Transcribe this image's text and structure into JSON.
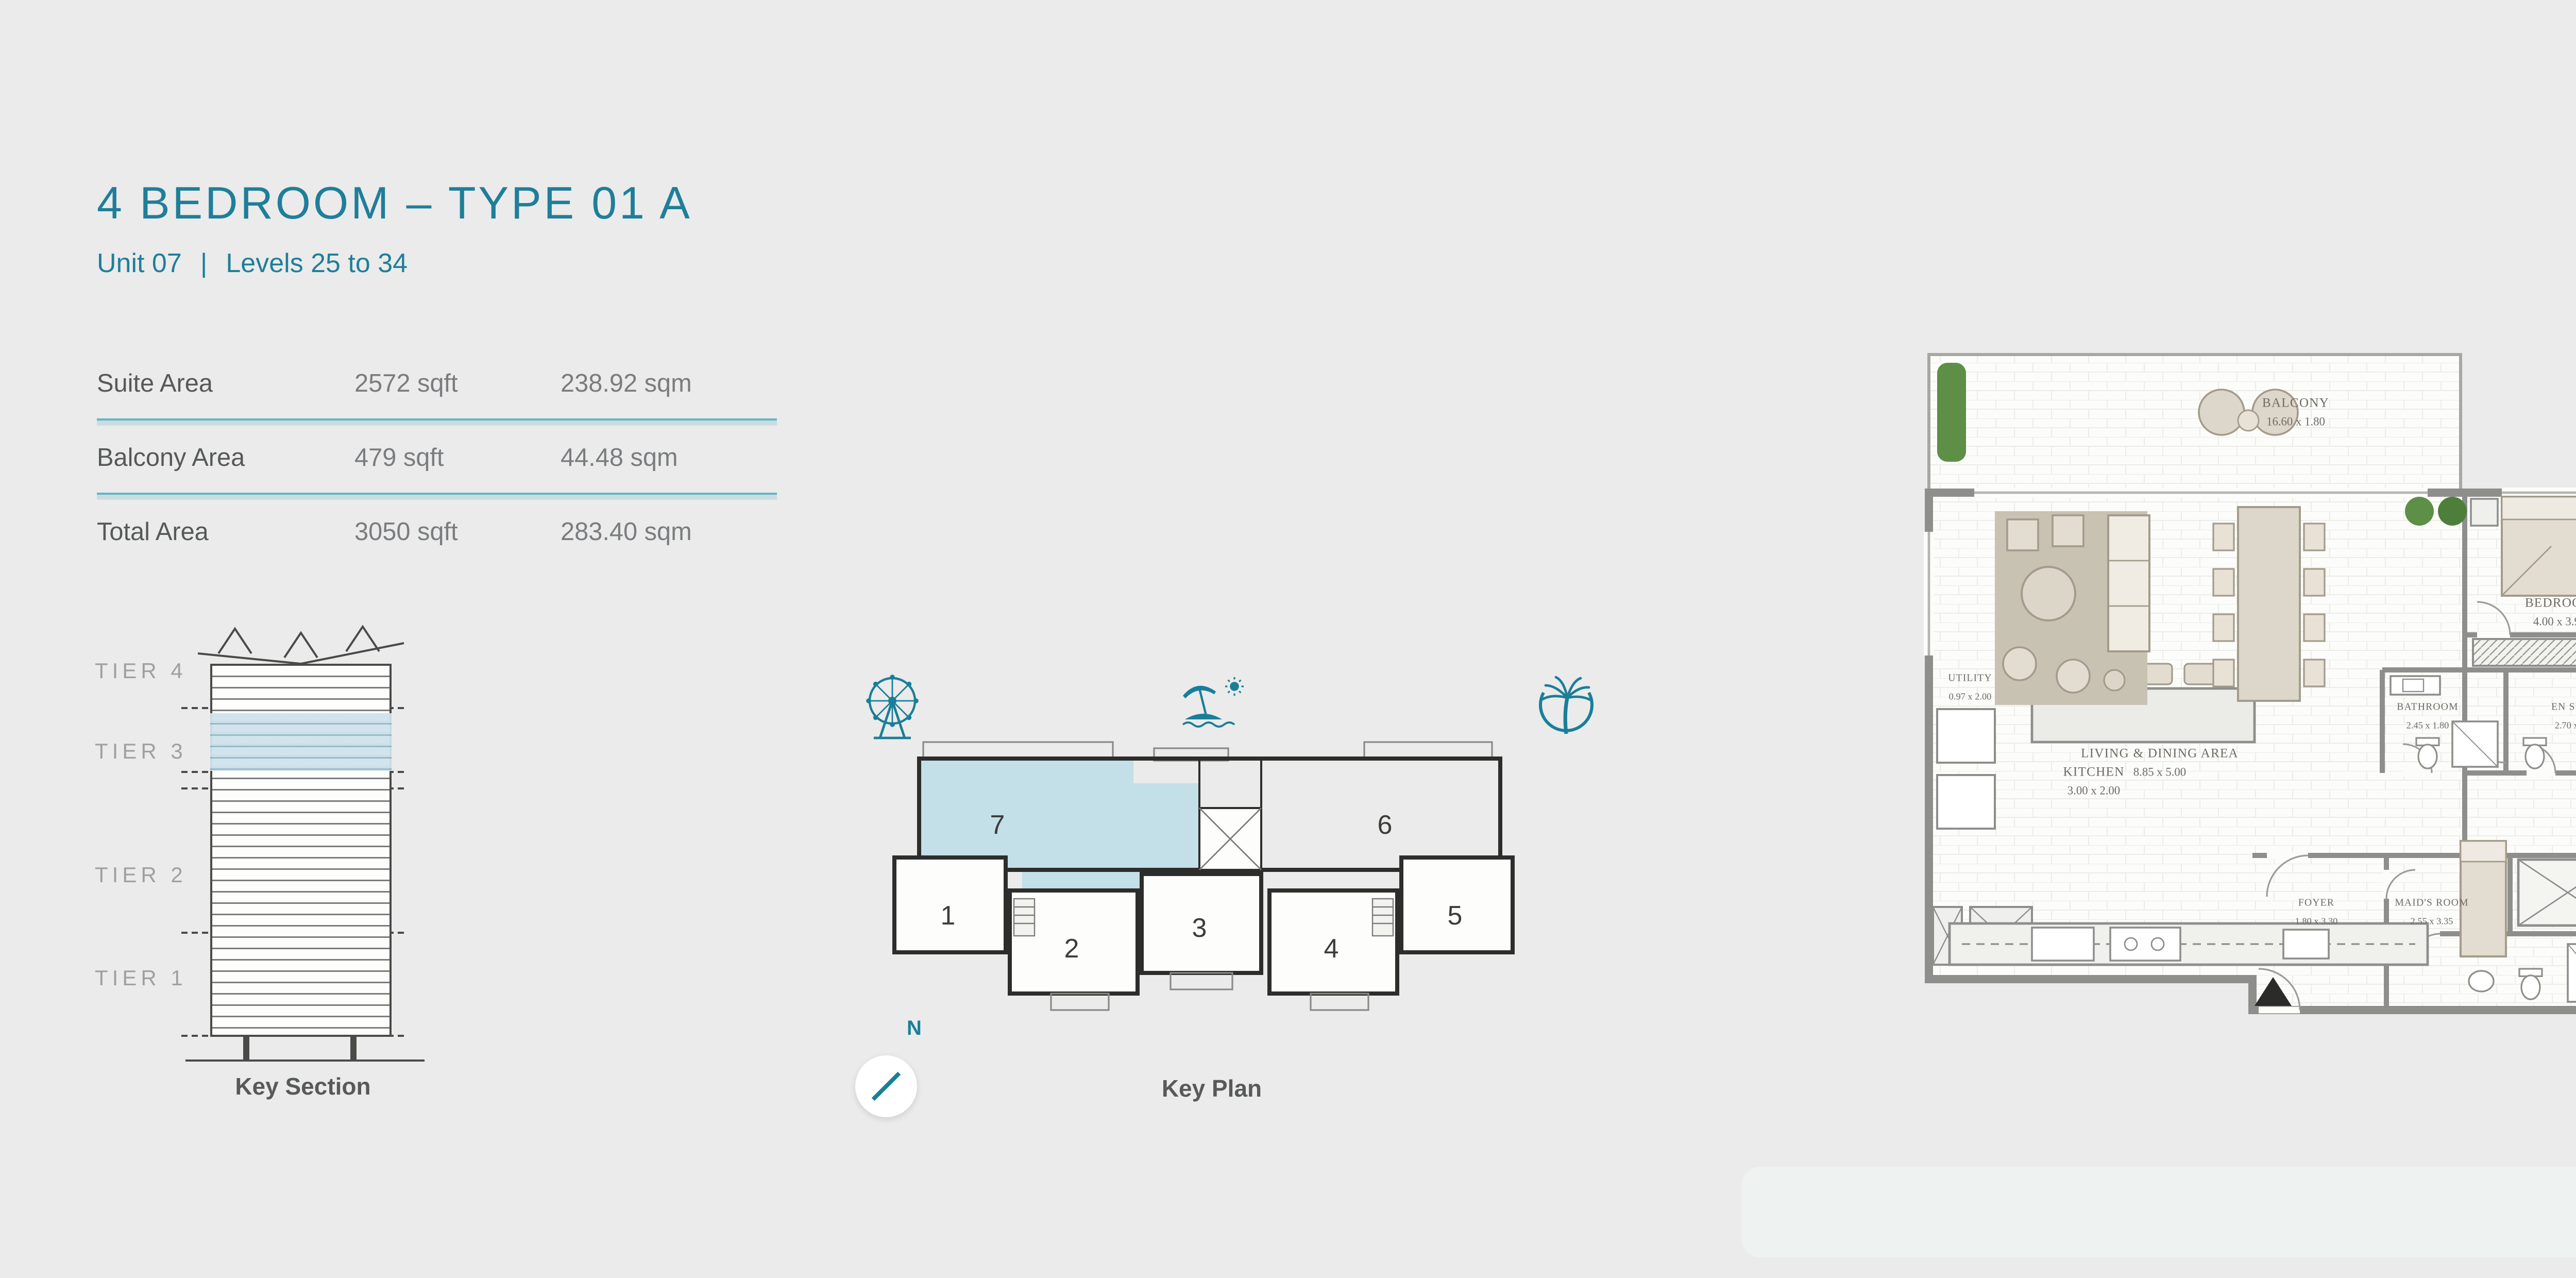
{
  "header": {
    "title": "4 BEDROOM  –  TYPE 01 A",
    "unit": "Unit 07",
    "separator": "|",
    "levels": "Levels 25 to 34",
    "accent_color": "#1f7e9a"
  },
  "area_table": {
    "rows": [
      {
        "label": "Suite Area",
        "sqft": "2572 sqft",
        "sqm": "238.92 sqm"
      },
      {
        "label": "Balcony Area",
        "sqft": "479 sqft",
        "sqm": "44.48 sqm"
      },
      {
        "label": "Total Area",
        "sqft": "3050 sqft",
        "sqm": "283.40 sqm"
      }
    ]
  },
  "key_section": {
    "caption": "Key Section",
    "tiers": [
      "TIER 4",
      "TIER 3",
      "TIER 2",
      "TIER 1"
    ],
    "highlight_color": "#cfe3ec"
  },
  "key_plan": {
    "caption": "Key Plan",
    "north": "N",
    "units": [
      "1",
      "2",
      "3",
      "4",
      "5",
      "6",
      "7"
    ],
    "highlighted_unit": "7",
    "icons": [
      "ferris-wheel-icon",
      "beach-icon",
      "palm-tree-icon"
    ],
    "highlight_color": "#c3dfe7"
  },
  "floor_plan": {
    "rooms": {
      "balcony_main": {
        "name": "BALCONY",
        "dims": "16.60 x 1.80"
      },
      "living": {
        "name": "LIVING & DINING AREA",
        "dims": "8.85 x 5.00"
      },
      "utility": {
        "name": "UTILITY",
        "dims": "0.97 x 2.00"
      },
      "kitchen": {
        "name": "KITCHEN",
        "dims": "3.00 x 2.00"
      },
      "bedroom1": {
        "name": "BEDROOM",
        "dims": "4.00 x 3.90"
      },
      "bathroom1": {
        "name": "BATHROOM",
        "dims": "2.45 x 1.80"
      },
      "bedroom2": {
        "name": "BEDROOM",
        "dims": "3.85 x 3.90"
      },
      "ensuite1": {
        "name": "EN SUITE",
        "dims": "2.70 x 1.90"
      },
      "corridor": {
        "name": "CORRIDOR",
        "dims": "12.70 x 1.10"
      },
      "bedroom3": {
        "name": "BEDROOM",
        "dims": "4.10 x 4.00"
      },
      "master_bedroom": {
        "name": "MASTER BEDROOM",
        "dims": "4.30 x 4.60"
      },
      "dressing": {
        "name": "DRESSING",
        "dims": "2.65 x 1.40"
      },
      "ensuite_master": {
        "name": "EN SUITE",
        "dims": "4.60 x 2.75"
      },
      "bathroom2": {
        "name": "BATHROOM",
        "dims": "2.00 x 2.35"
      },
      "foyer": {
        "name": "FOYER",
        "dims": "1.80 x 3.30"
      },
      "maids_room": {
        "name": "MAID'S ROOM",
        "dims": "2.55 x 3.35"
      },
      "balcony_right": {
        "name": "BALCONY",
        "dims": "3.05 x 1.80"
      }
    }
  }
}
